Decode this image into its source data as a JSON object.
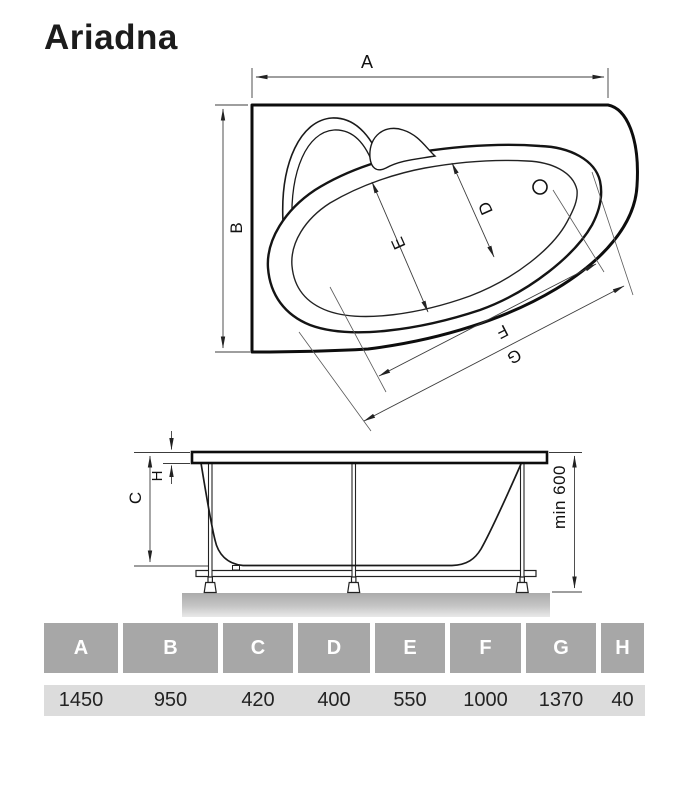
{
  "title": "Ariadna",
  "top_view": {
    "label_a": "A",
    "label_b": "B",
    "label_d": "D",
    "label_e": "E",
    "label_f": "F",
    "label_g": "G"
  },
  "side_view": {
    "label_c": "C",
    "label_h": "H",
    "label_min_height": "min 600"
  },
  "table": {
    "headers": [
      "A",
      "B",
      "C",
      "D",
      "E",
      "F",
      "G",
      "H"
    ],
    "values": [
      "1450",
      "950",
      "420",
      "400",
      "550",
      "1000",
      "1370",
      "40"
    ]
  },
  "colors": {
    "table_header_bg": "#a7a7a7",
    "table_header_text": "#ffffff",
    "table_value_bg": "#dcdcdc",
    "drawing_line": "#111111",
    "dimension_line": "#3c3c3c",
    "ground_gray": "#b0b0b0"
  }
}
